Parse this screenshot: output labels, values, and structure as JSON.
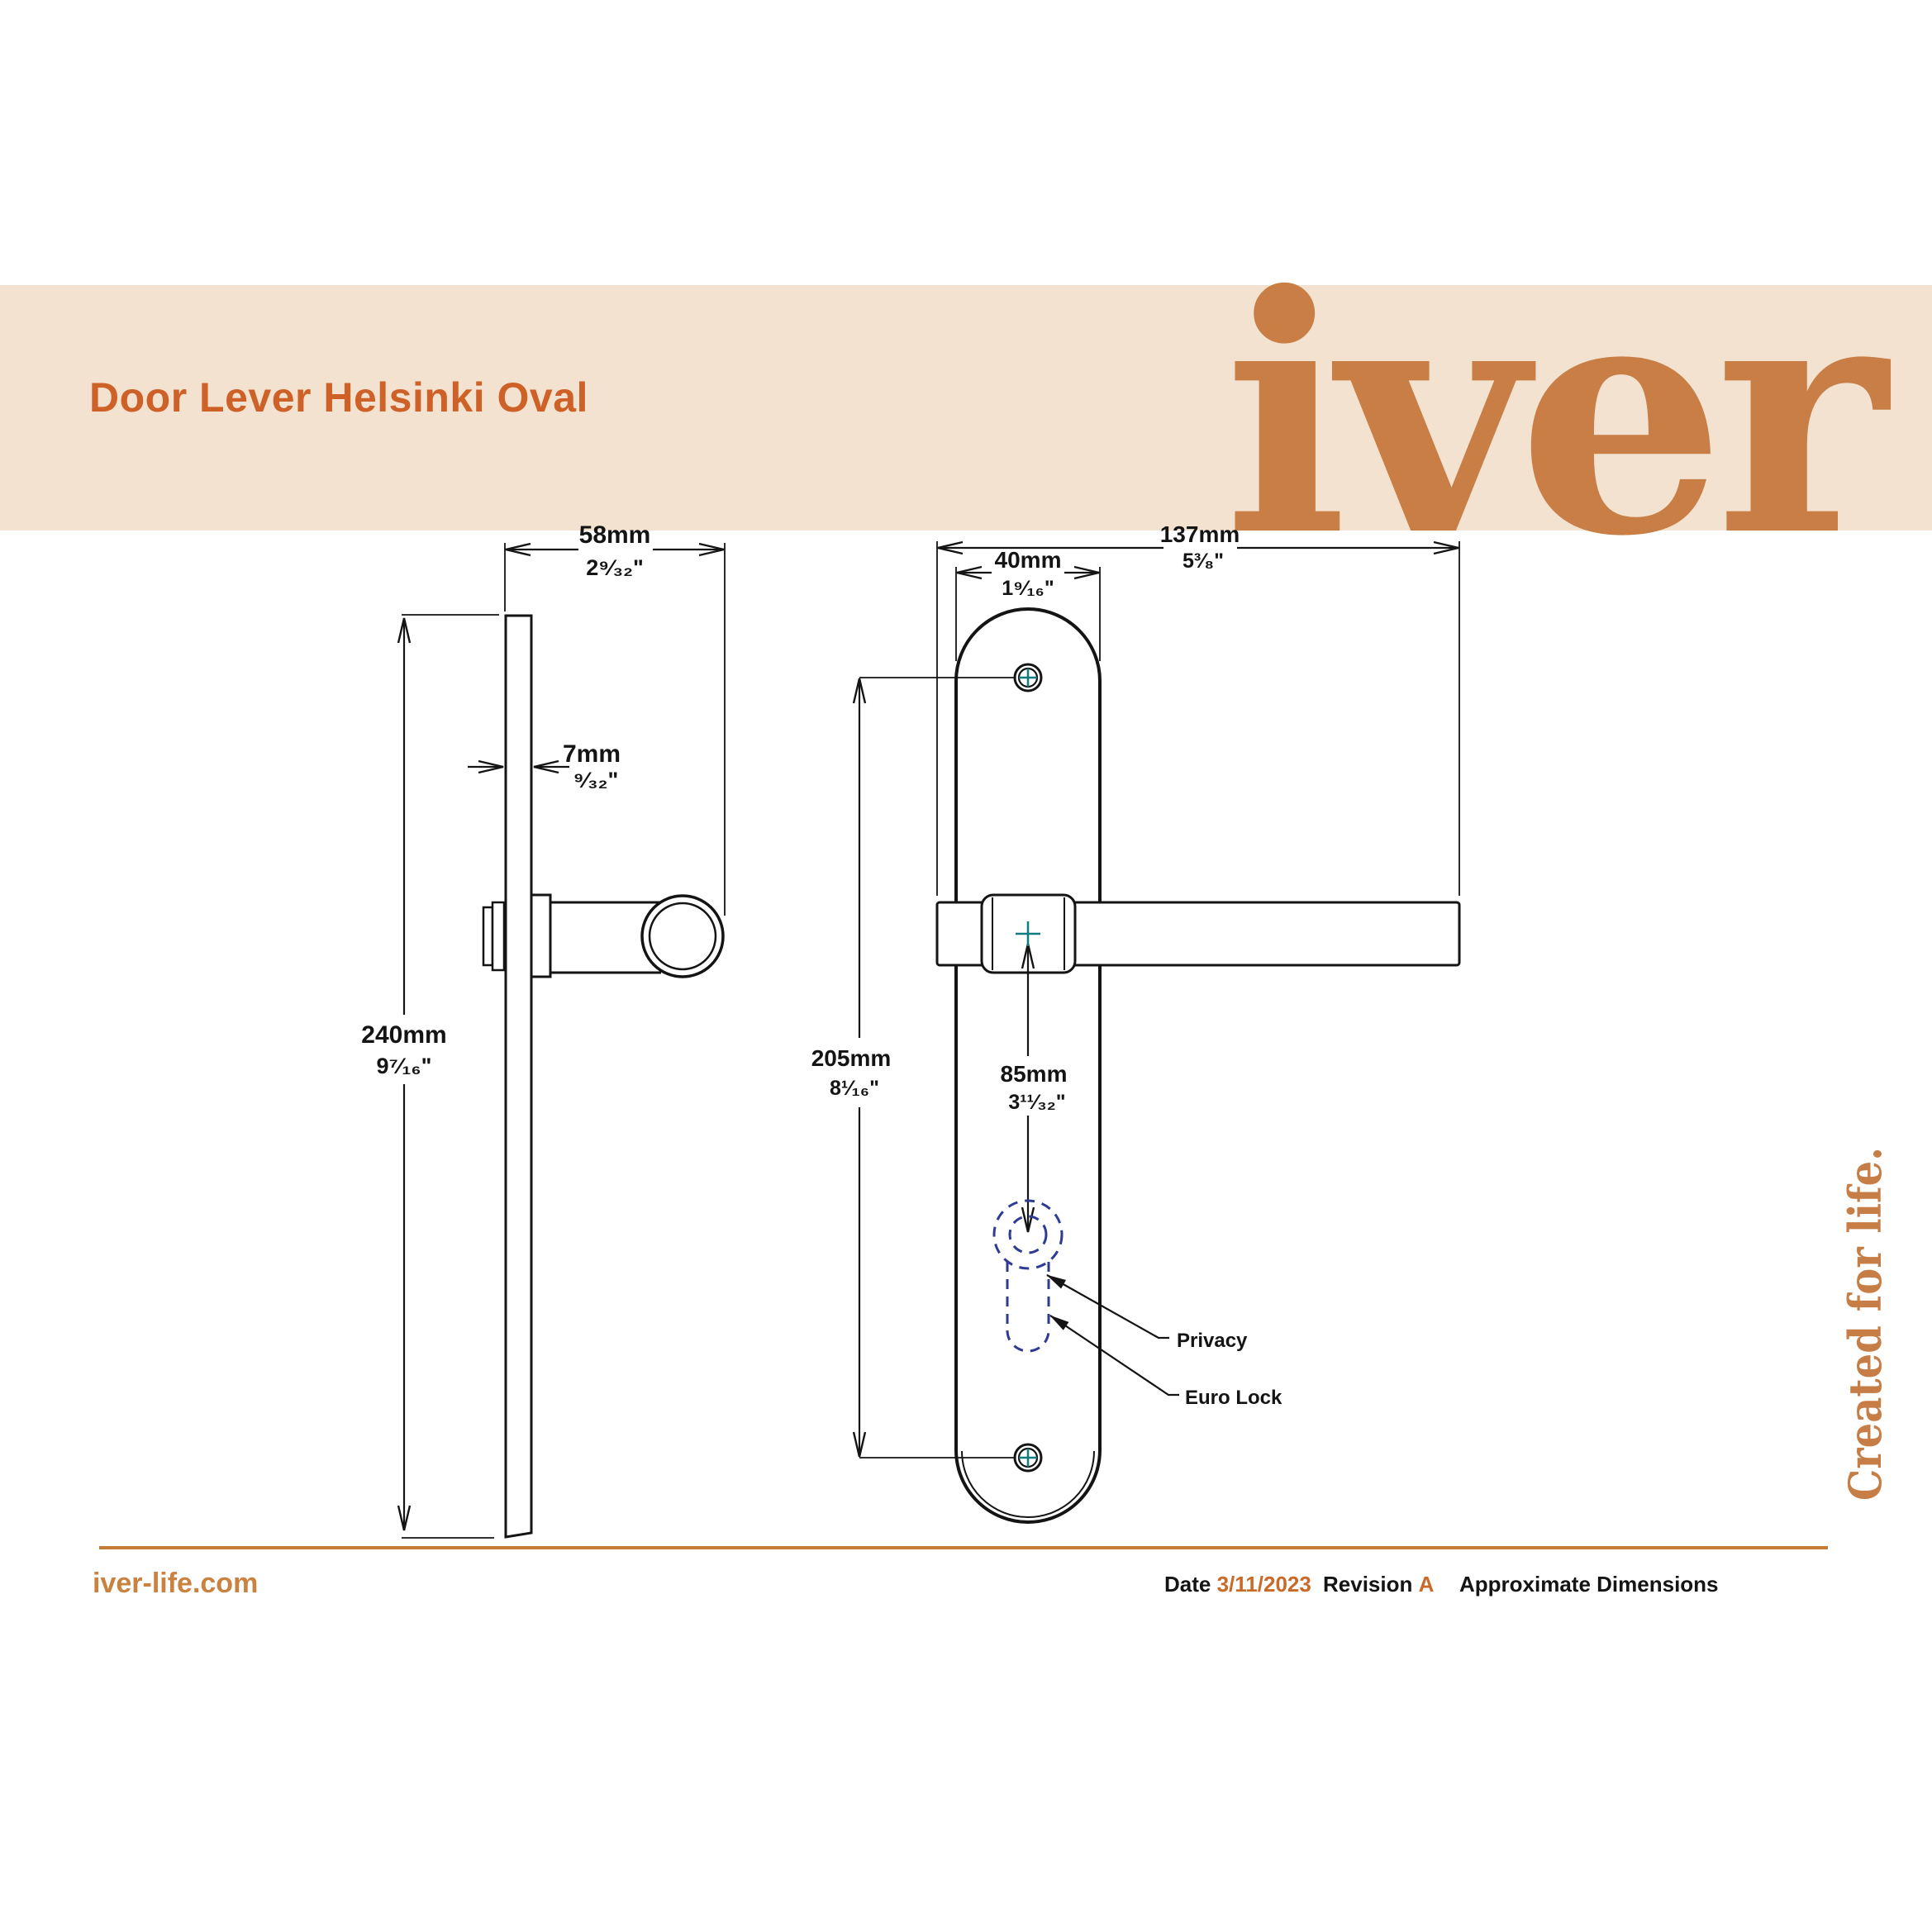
{
  "header": {
    "title": "Door Lever Helsinki Oval",
    "logo": "iver"
  },
  "side_view": {
    "width_mm": "58mm",
    "width_in": "2⁹⁄₃₂\"",
    "thickness_mm": "7mm",
    "thickness_in": "⁹⁄₃₂\"",
    "height_mm": "240mm",
    "height_in": "9⁷⁄₁₆\""
  },
  "front_view": {
    "length_mm": "137mm",
    "length_in": "5³⁄₈\"",
    "plate_width_mm": "40mm",
    "plate_width_in": "1⁹⁄₁₆\"",
    "screw_centres_mm": "205mm",
    "screw_centres_in": "8¹⁄₁₆\"",
    "lock_centre_mm": "85mm",
    "lock_centre_in": "3¹¹⁄₃₂\"",
    "privacy_label": "Privacy",
    "euro_lock_label": "Euro Lock"
  },
  "tagline": "Created for life.",
  "footer": {
    "website": "iver-life.com",
    "date_label": "Date",
    "date_value": "3/11/2023",
    "revision_label": "Revision",
    "revision_value": "A",
    "note": "Approximate Dimensions"
  },
  "colors": {
    "band": "#F3E2D0",
    "title_accent": "#CE6127",
    "logo_orange": "#C87E44",
    "tagline_orange": "#C67E46",
    "footer_rule": "#C67A38",
    "link_orange": "#C9823F",
    "value_orange": "#C96A28",
    "line_ink": "#141414",
    "centre_mark_teal": "#107C7C",
    "keyhole_navy": "#2E3B93"
  }
}
